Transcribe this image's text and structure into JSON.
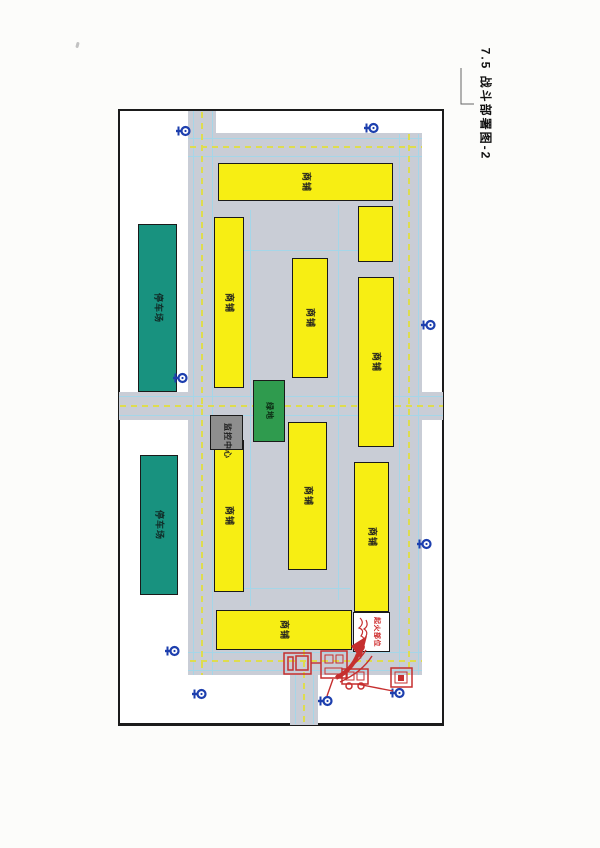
{
  "page": {
    "title": "7.5 战斗部署图-2"
  },
  "map": {
    "labels": {
      "shop": "商铺",
      "parking": "停车场",
      "green_area": "绿地",
      "control_center": "监控中心",
      "fire_origin": "起火部位"
    },
    "colors": {
      "road_gray": "#c9cdd6",
      "building_yellow": "#f7ee13",
      "parking_teal": "#18927f",
      "green_block": "#2f9b4e",
      "control_gray": "#8e8e8e",
      "hydrant_blue": "#1d3fae",
      "deploy_red": "#c62f2f",
      "center_line_yellow": "#dedc4e",
      "guide_line_blue": "#a5d6e8"
    },
    "frame": {
      "x": 118,
      "y": 109,
      "w": 326,
      "h": 617
    },
    "roads": [
      {
        "x": 188,
        "y": 133,
        "w": 234,
        "h": 542
      },
      {
        "x": 188,
        "y": 111,
        "w": 28,
        "h": 24
      },
      {
        "x": 119,
        "y": 392,
        "w": 324,
        "h": 28
      },
      {
        "x": 290,
        "y": 675,
        "w": 28,
        "h": 50
      }
    ],
    "center_lines": [
      {
        "dir": "v",
        "x": 201,
        "y1": 112,
        "y2": 675
      },
      {
        "dir": "v",
        "x": 408,
        "y1": 134,
        "y2": 675
      },
      {
        "dir": "h",
        "y": 146,
        "x1": 190,
        "x2": 422
      },
      {
        "dir": "h",
        "y": 660,
        "x1": 190,
        "x2": 422
      },
      {
        "dir": "h",
        "y": 405,
        "x1": 120,
        "x2": 443
      },
      {
        "dir": "v",
        "x": 303,
        "y1": 650,
        "y2": 724
      }
    ],
    "guide_lines": [
      {
        "dir": "h",
        "y": 138,
        "x1": 188,
        "x2": 422
      },
      {
        "dir": "h",
        "y": 156,
        "x1": 188,
        "x2": 422
      },
      {
        "dir": "h",
        "y": 396,
        "x1": 119,
        "x2": 443
      },
      {
        "dir": "h",
        "y": 415,
        "x1": 119,
        "x2": 443
      },
      {
        "dir": "h",
        "y": 652,
        "x1": 188,
        "x2": 422
      },
      {
        "dir": "h",
        "y": 670,
        "x1": 188,
        "x2": 422
      },
      {
        "dir": "v",
        "x": 193,
        "y1": 111,
        "y2": 675
      },
      {
        "dir": "v",
        "x": 212,
        "y1": 111,
        "y2": 675
      },
      {
        "dir": "v",
        "x": 399,
        "y1": 134,
        "y2": 675
      },
      {
        "dir": "v",
        "x": 418,
        "y1": 134,
        "y2": 675
      },
      {
        "dir": "v",
        "x": 295,
        "y1": 675,
        "y2": 724
      },
      {
        "dir": "v",
        "x": 313,
        "y1": 675,
        "y2": 724
      },
      {
        "dir": "v",
        "x": 250,
        "y1": 210,
        "y2": 606
      },
      {
        "dir": "v",
        "x": 338,
        "y1": 205,
        "y2": 600
      },
      {
        "dir": "h",
        "y": 250,
        "x1": 216,
        "x2": 393
      },
      {
        "dir": "h",
        "y": 588,
        "x1": 216,
        "x2": 350
      }
    ],
    "buildings": [
      {
        "x": 218,
        "y": 163,
        "w": 175,
        "h": 38,
        "labeled": true
      },
      {
        "x": 358,
        "y": 206,
        "w": 35,
        "h": 56,
        "labeled": false
      },
      {
        "x": 214,
        "y": 217,
        "w": 30,
        "h": 171,
        "labeled": true
      },
      {
        "x": 292,
        "y": 258,
        "w": 36,
        "h": 120,
        "labeled": true
      },
      {
        "x": 358,
        "y": 277,
        "w": 36,
        "h": 170,
        "labeled": true
      },
      {
        "x": 214,
        "y": 440,
        "w": 30,
        "h": 152,
        "labeled": true
      },
      {
        "x": 288,
        "y": 422,
        "w": 39,
        "h": 148,
        "labeled": true
      },
      {
        "x": 354,
        "y": 462,
        "w": 35,
        "h": 150,
        "labeled": true
      },
      {
        "x": 216,
        "y": 610,
        "w": 136,
        "h": 40,
        "labeled": true
      }
    ],
    "parking_lots": [
      {
        "x": 138,
        "y": 224,
        "w": 39,
        "h": 168
      },
      {
        "x": 140,
        "y": 455,
        "w": 38,
        "h": 140
      }
    ],
    "green_block": {
      "x": 253,
      "y": 380,
      "w": 32,
      "h": 62
    },
    "control_block": {
      "x": 210,
      "y": 415,
      "w": 33,
      "h": 35
    },
    "fire_box": {
      "x": 353,
      "y": 612,
      "w": 37,
      "h": 40
    },
    "hydrants": [
      {
        "x": 183,
        "y": 130
      },
      {
        "x": 371,
        "y": 127
      },
      {
        "x": 428,
        "y": 324
      },
      {
        "x": 180,
        "y": 377
      },
      {
        "x": 424,
        "y": 543
      },
      {
        "x": 172,
        "y": 650
      },
      {
        "x": 199,
        "y": 693
      },
      {
        "x": 325,
        "y": 700
      },
      {
        "x": 397,
        "y": 692
      }
    ]
  }
}
